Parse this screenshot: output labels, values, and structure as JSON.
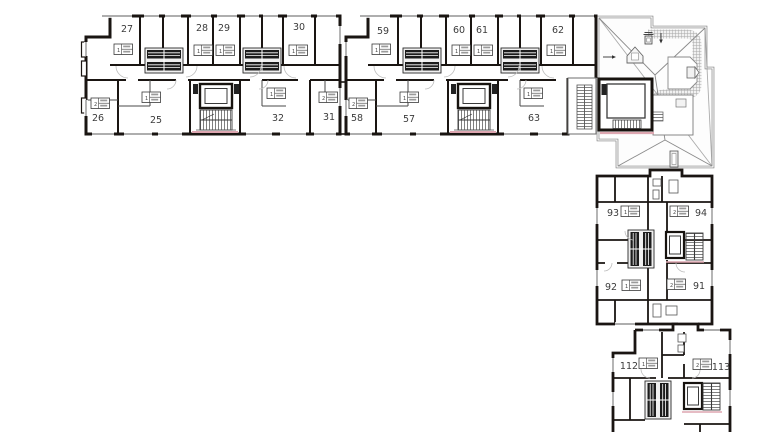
{
  "plan": {
    "colors": {
      "wall": "#1a1512",
      "thin_line": "#6e6e6e",
      "hatch": "#a8a8a8",
      "canopy_pink": "#dda6b0",
      "label_text": "#3c3c3c",
      "balcony_dark": "#1c1c1c"
    },
    "units": [
      {
        "number": "27",
        "rooms": "1"
      },
      {
        "number": "28",
        "rooms": "1"
      },
      {
        "number": "29",
        "rooms": "1"
      },
      {
        "number": "30",
        "rooms": "1"
      },
      {
        "number": "26",
        "rooms": "2"
      },
      {
        "number": "25",
        "rooms": "1"
      },
      {
        "number": "32",
        "rooms": "1"
      },
      {
        "number": "31",
        "rooms": "2"
      },
      {
        "number": "59",
        "rooms": "1"
      },
      {
        "number": "60",
        "rooms": "1"
      },
      {
        "number": "61",
        "rooms": "1"
      },
      {
        "number": "62",
        "rooms": "1"
      },
      {
        "number": "58",
        "rooms": "2"
      },
      {
        "number": "57",
        "rooms": "1"
      },
      {
        "number": "63",
        "rooms": "1"
      },
      {
        "number": "93",
        "rooms": "1"
      },
      {
        "number": "94",
        "rooms": "2"
      },
      {
        "number": "92",
        "rooms": "1"
      },
      {
        "number": "91",
        "rooms": "2"
      },
      {
        "number": "112",
        "rooms": "1"
      },
      {
        "number": "113",
        "rooms": "2"
      }
    ]
  }
}
